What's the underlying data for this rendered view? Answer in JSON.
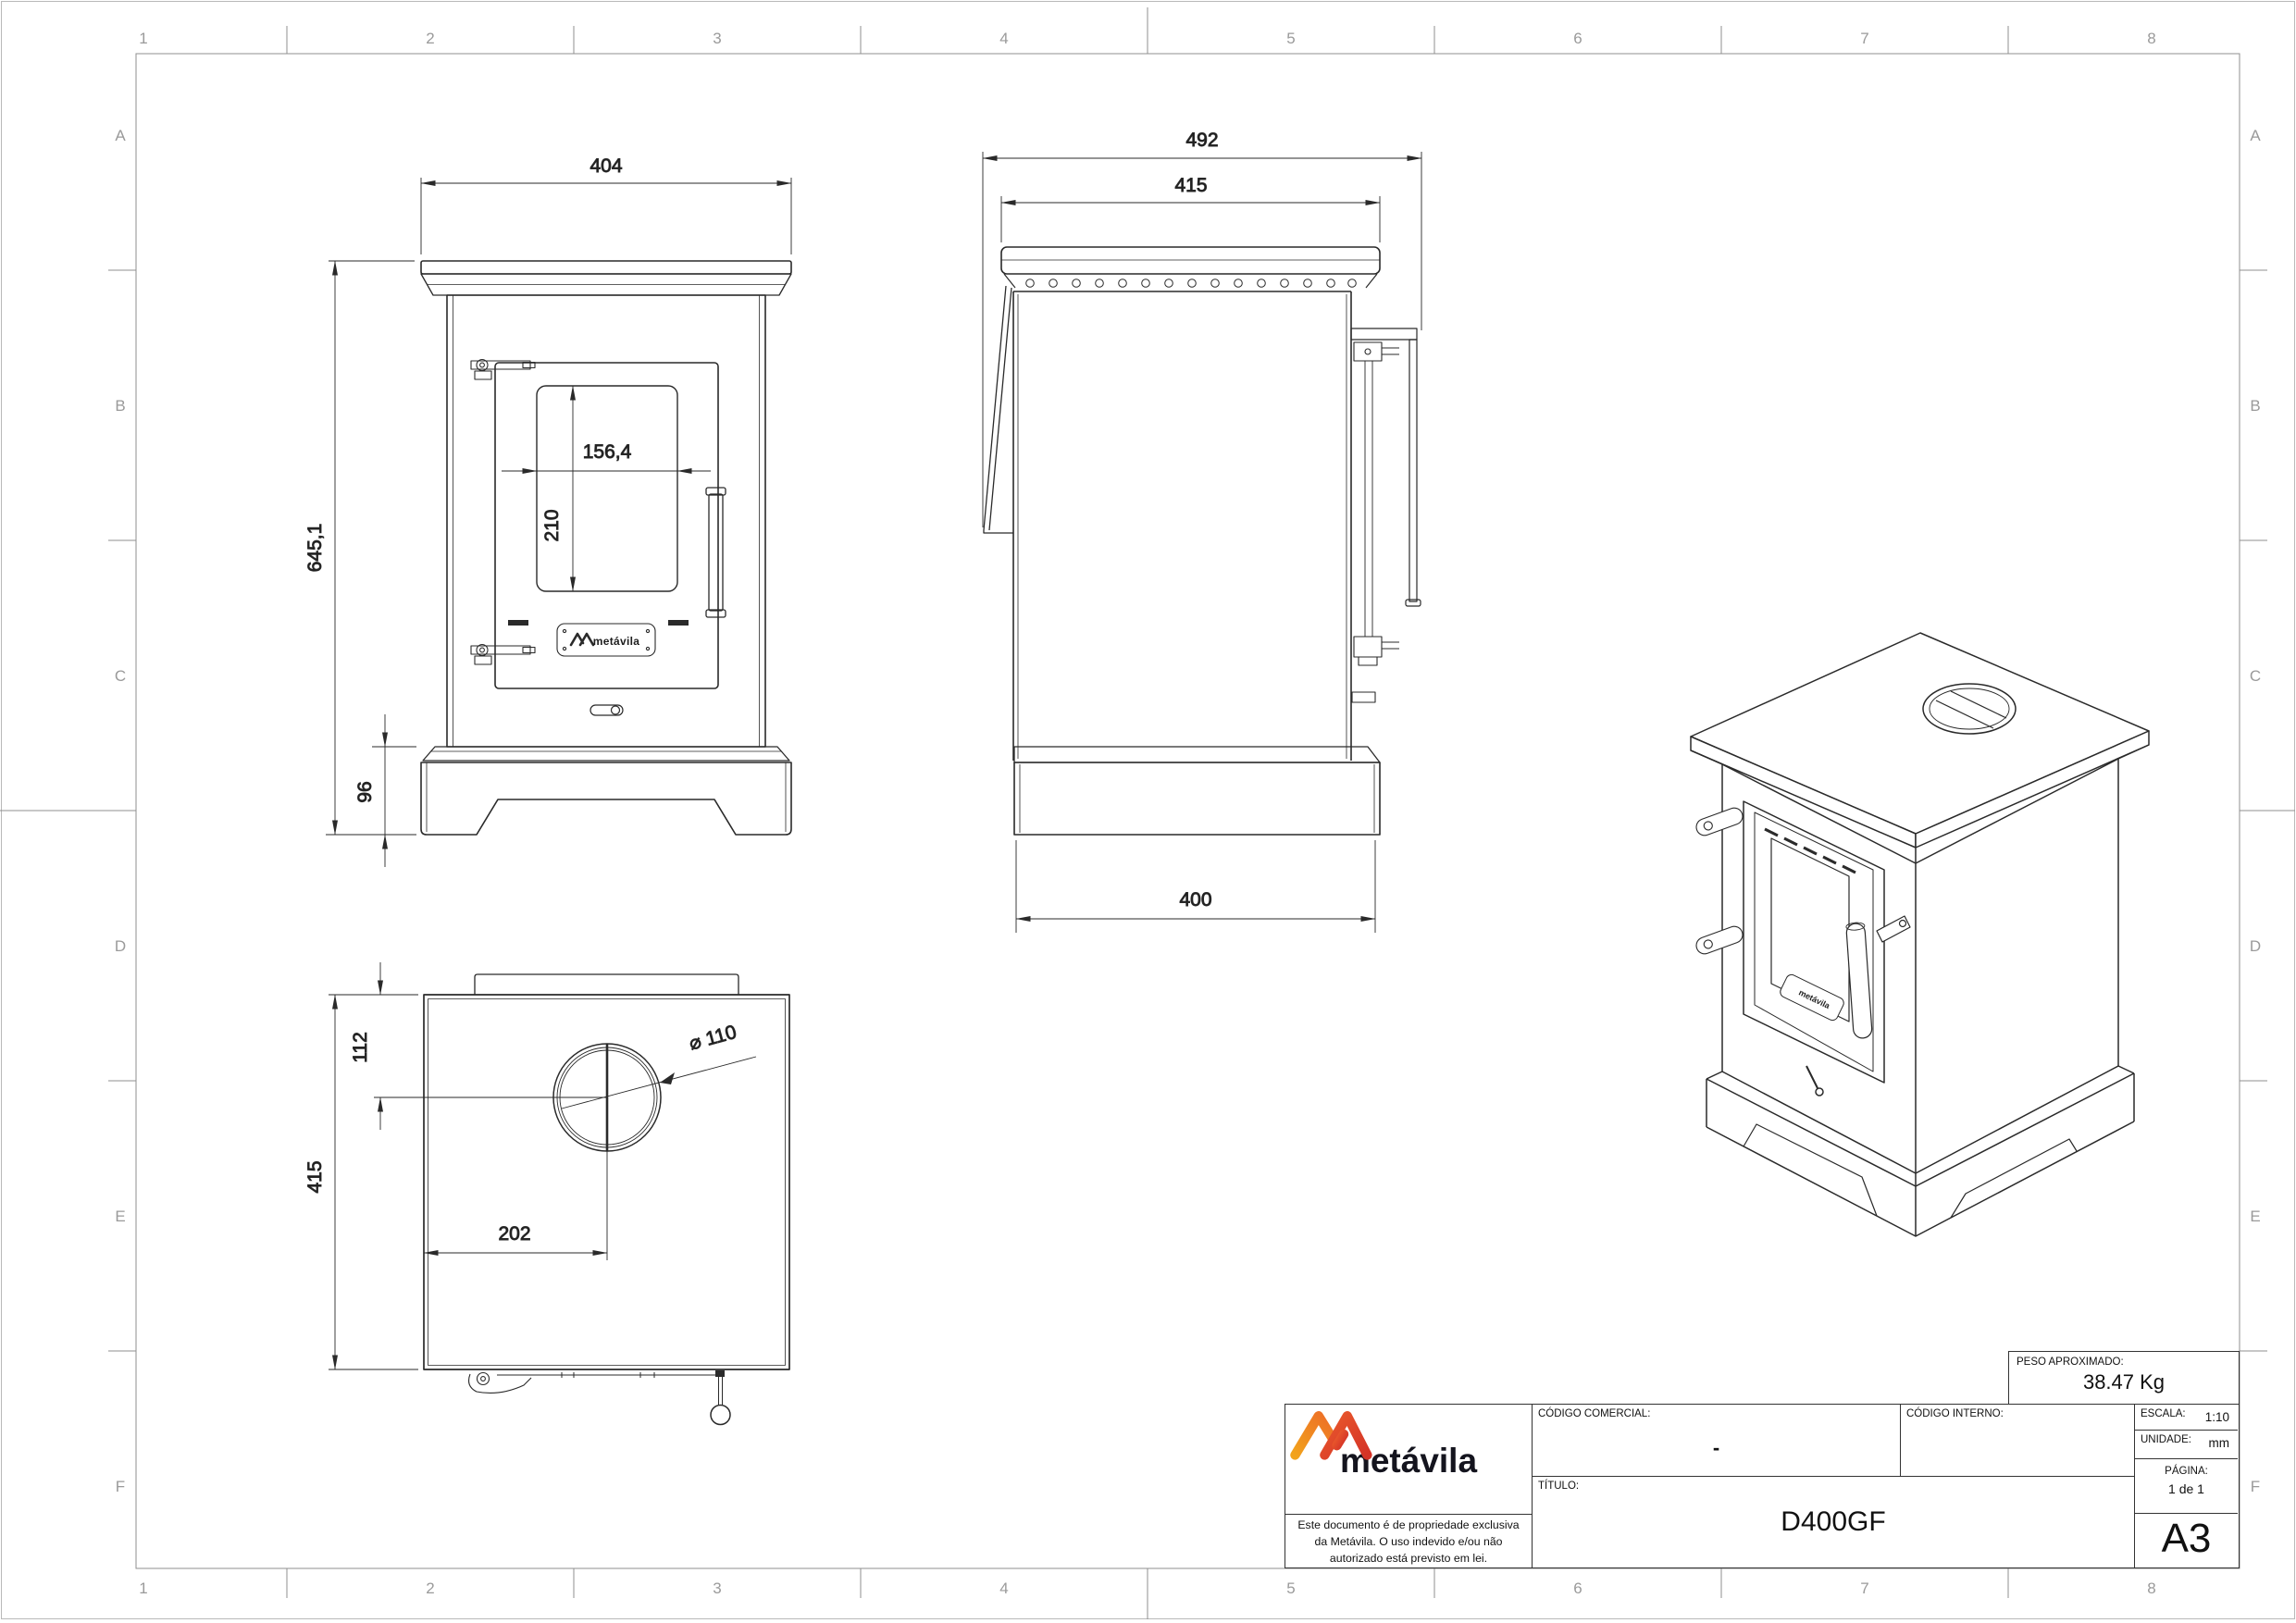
{
  "colors": {
    "line": "#2a2a2a",
    "frame_gray": "#8a8a8a",
    "zone_label_gray": "#9a9a9a",
    "brand_orange": "#F29A1E",
    "brand_red": "#DF3A2A",
    "brand_dark": "#14141e"
  },
  "zones": {
    "cols": [
      "1",
      "2",
      "3",
      "4",
      "5",
      "6",
      "7",
      "8"
    ],
    "rows": [
      "A",
      "B",
      "C",
      "D",
      "E",
      "F"
    ]
  },
  "views": {
    "front": {
      "dims": {
        "width": "404",
        "total_height": "645,1",
        "glass_width": "156,4",
        "glass_height": "210",
        "base_height": "96"
      }
    },
    "side": {
      "dims": {
        "total_depth": "492",
        "top_plate_depth": "415",
        "base_depth": "400"
      }
    },
    "top": {
      "dims": {
        "flue_center_from_back": "112",
        "plate_depth": "415",
        "flue_center_from_left": "202",
        "flue_diameter": "⌀ 110"
      }
    }
  },
  "logo": {
    "wordmark": "metávila",
    "door_plate_text": "metávila"
  },
  "title_block": {
    "codigo_comercial_label": "CÓDIGO COMERCIAL:",
    "codigo_comercial_value": "-",
    "codigo_interno_label": "CÓDIGO INTERNO:",
    "titulo_label": "TÍTULO:",
    "titulo_value": "D400GF",
    "escala_label": "ESCALA:",
    "escala_value": "1:10",
    "unidade_label": "UNIDADE:",
    "unidade_value": "mm",
    "pagina_label": "PÁGINA:",
    "pagina_value": "1 de 1",
    "sheet_size": "A3",
    "peso_label": "PESO APROXIMADO:",
    "peso_value": "38.47 Kg",
    "disclaimer_line1": "Este documento é de propriedade exclusiva",
    "disclaimer_line2": "da Metávila. O uso indevido e/ou não",
    "disclaimer_line3": "autorizado está previsto em lei."
  }
}
